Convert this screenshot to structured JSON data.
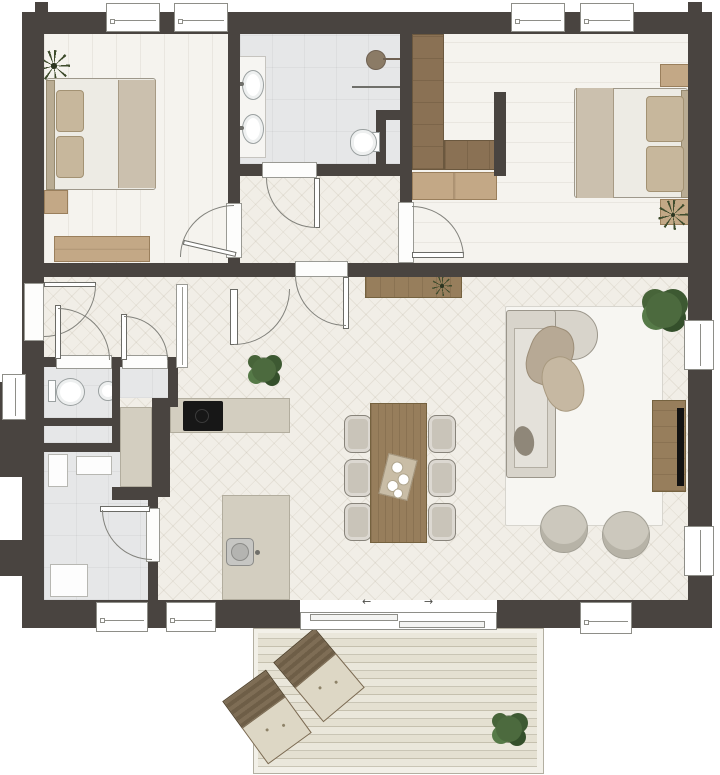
{
  "plan": {
    "kind": "residential-floor-plan-top-view",
    "rooms": [
      {
        "id": "bedroom-1",
        "position": "top-left",
        "furniture": [
          "double-bed",
          "nightstand",
          "dresser",
          "plant"
        ]
      },
      {
        "id": "bathroom",
        "position": "top-center",
        "furniture": [
          "double-vanity",
          "two-sinks",
          "shower",
          "toilet"
        ]
      },
      {
        "id": "bedroom-2",
        "position": "top-right",
        "furniture": [
          "double-bed",
          "two-nightstands",
          "l-wardrobe",
          "bench-shelf",
          "plant"
        ]
      },
      {
        "id": "inner-corridor",
        "position": "center-top",
        "furniture": []
      },
      {
        "id": "entrance-hall",
        "position": "center-left",
        "furniture": [
          "front-door"
        ]
      },
      {
        "id": "wc",
        "position": "left",
        "furniture": [
          "toilet",
          "round-basin"
        ]
      },
      {
        "id": "storage-closet",
        "position": "left",
        "furniture": []
      },
      {
        "id": "utility-room",
        "position": "bottom-left",
        "furniture": [
          "washer",
          "appliance",
          "cabinet",
          "counter"
        ]
      },
      {
        "id": "kitchen",
        "position": "center",
        "furniture": [
          "wall-counter",
          "cooktop",
          "island-with-sink",
          "floor-plant"
        ]
      },
      {
        "id": "dining-area",
        "position": "center",
        "furniture": [
          "table",
          "six-chairs",
          "serving-tray"
        ]
      },
      {
        "id": "living-area",
        "position": "right",
        "furniture": [
          "sofa-chaise",
          "rug",
          "two-poufs",
          "tv-console",
          "large-plant",
          "sideboard"
        ]
      },
      {
        "id": "deck",
        "position": "bottom",
        "furniture": [
          "two-lounge-chairs",
          "potted-plant"
        ]
      }
    ],
    "window_count": 10,
    "door_count": 9
  },
  "sliding_door": {
    "arrow_left": "←",
    "arrow_right": "→"
  },
  "palette": {
    "wall": "#494440",
    "wood_floor": "#f1eee7",
    "tile_floor": "#e6e7e8",
    "deck": "#e4e0d1",
    "wood_dark": "#8a7154",
    "wood_mid": "#977e5c",
    "wood_light": "#c3a886",
    "counter": "#d3cec0",
    "upholstery": "#c9c4b9",
    "plant_green": "#4c6a3e",
    "appliance_black": "#171717"
  }
}
